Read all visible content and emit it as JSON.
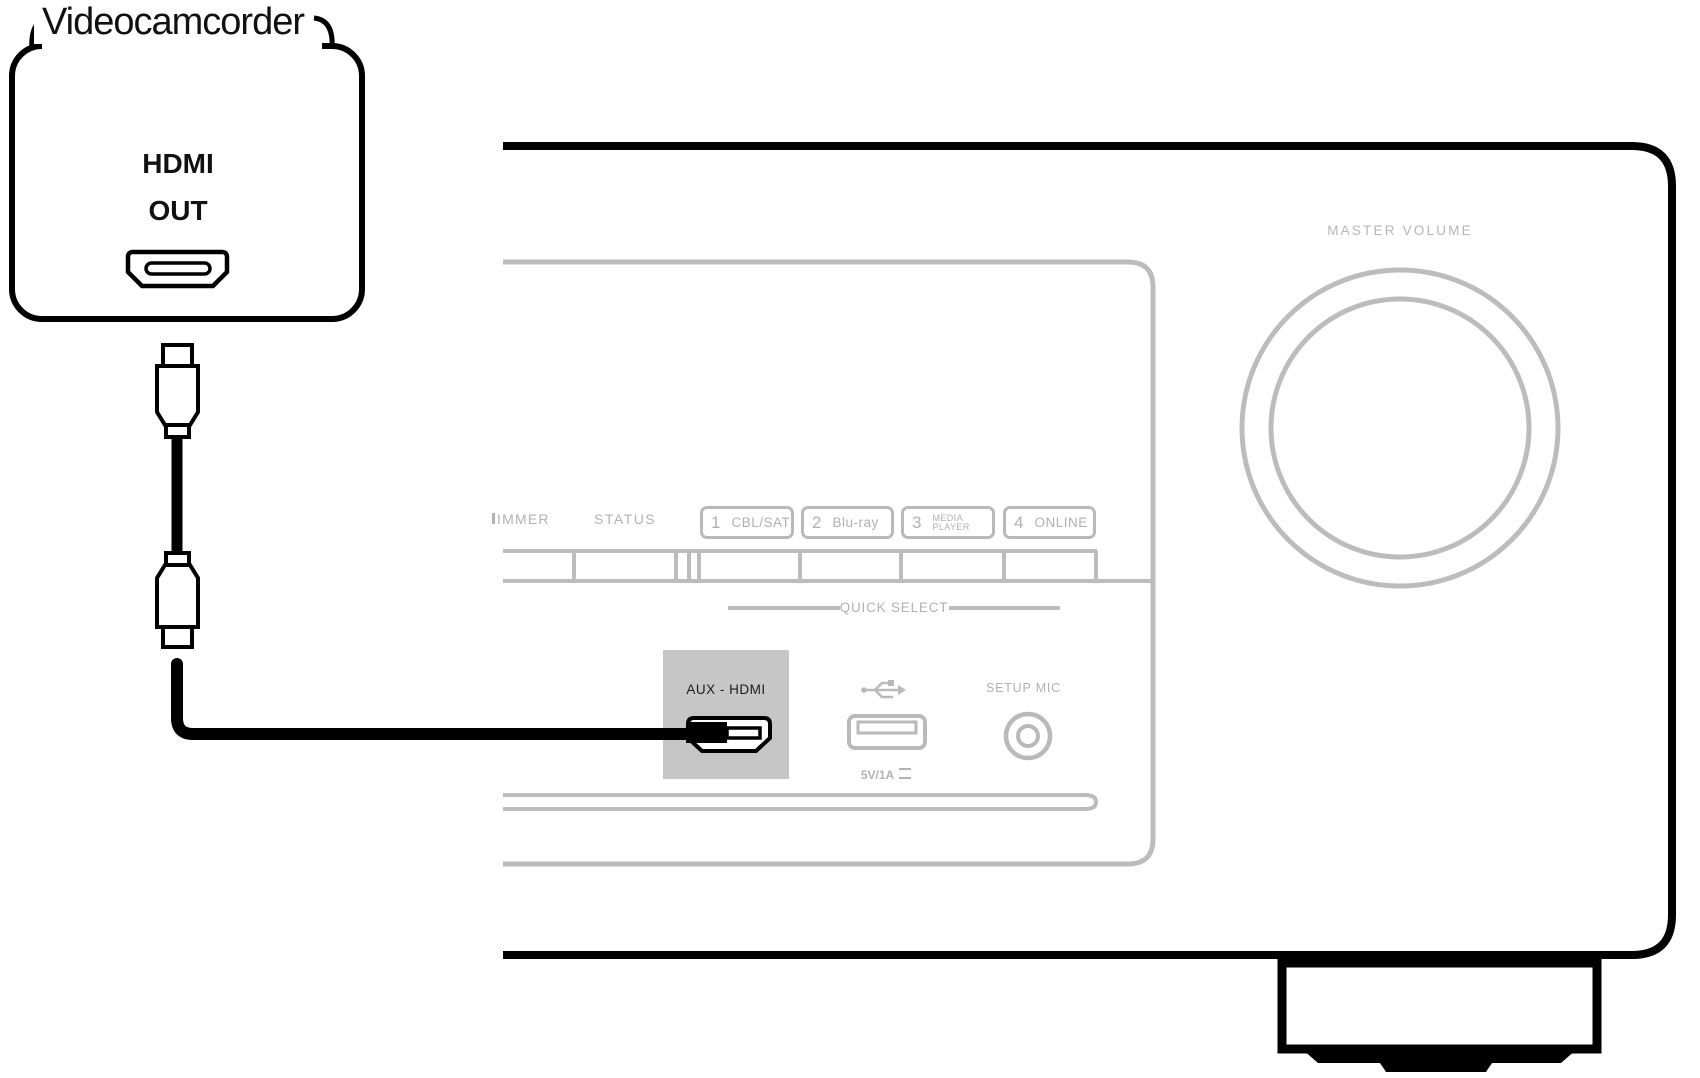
{
  "source_device": {
    "title": "Videocamcorder",
    "port_label_line1": "HDMI",
    "port_label_line2": "OUT"
  },
  "receiver": {
    "master_volume_label": "MASTER VOLUME",
    "display_labels": {
      "dimmer_clipped": "IMMER",
      "status": "STATUS"
    },
    "quick_select": {
      "title": "QUICK SELECT",
      "buttons": [
        {
          "number": "1",
          "label": "CBL/SAT"
        },
        {
          "number": "2",
          "label": "Blu-ray"
        },
        {
          "number": "3",
          "label": "MEDIA",
          "label2": "PLAYER"
        },
        {
          "number": "4",
          "label": "ONLINE"
        }
      ]
    },
    "front_inputs": {
      "aux_hdmi_label": "AUX - HDMI",
      "usb_power_label": "5V/1A",
      "setup_mic_label": "SETUP MIC"
    }
  },
  "colors": {
    "line_black": "#000000",
    "panel_gray": "#bcbcbc",
    "label_gray": "#b2b2b2",
    "highlight_box_gray": "#c6c6c6"
  }
}
